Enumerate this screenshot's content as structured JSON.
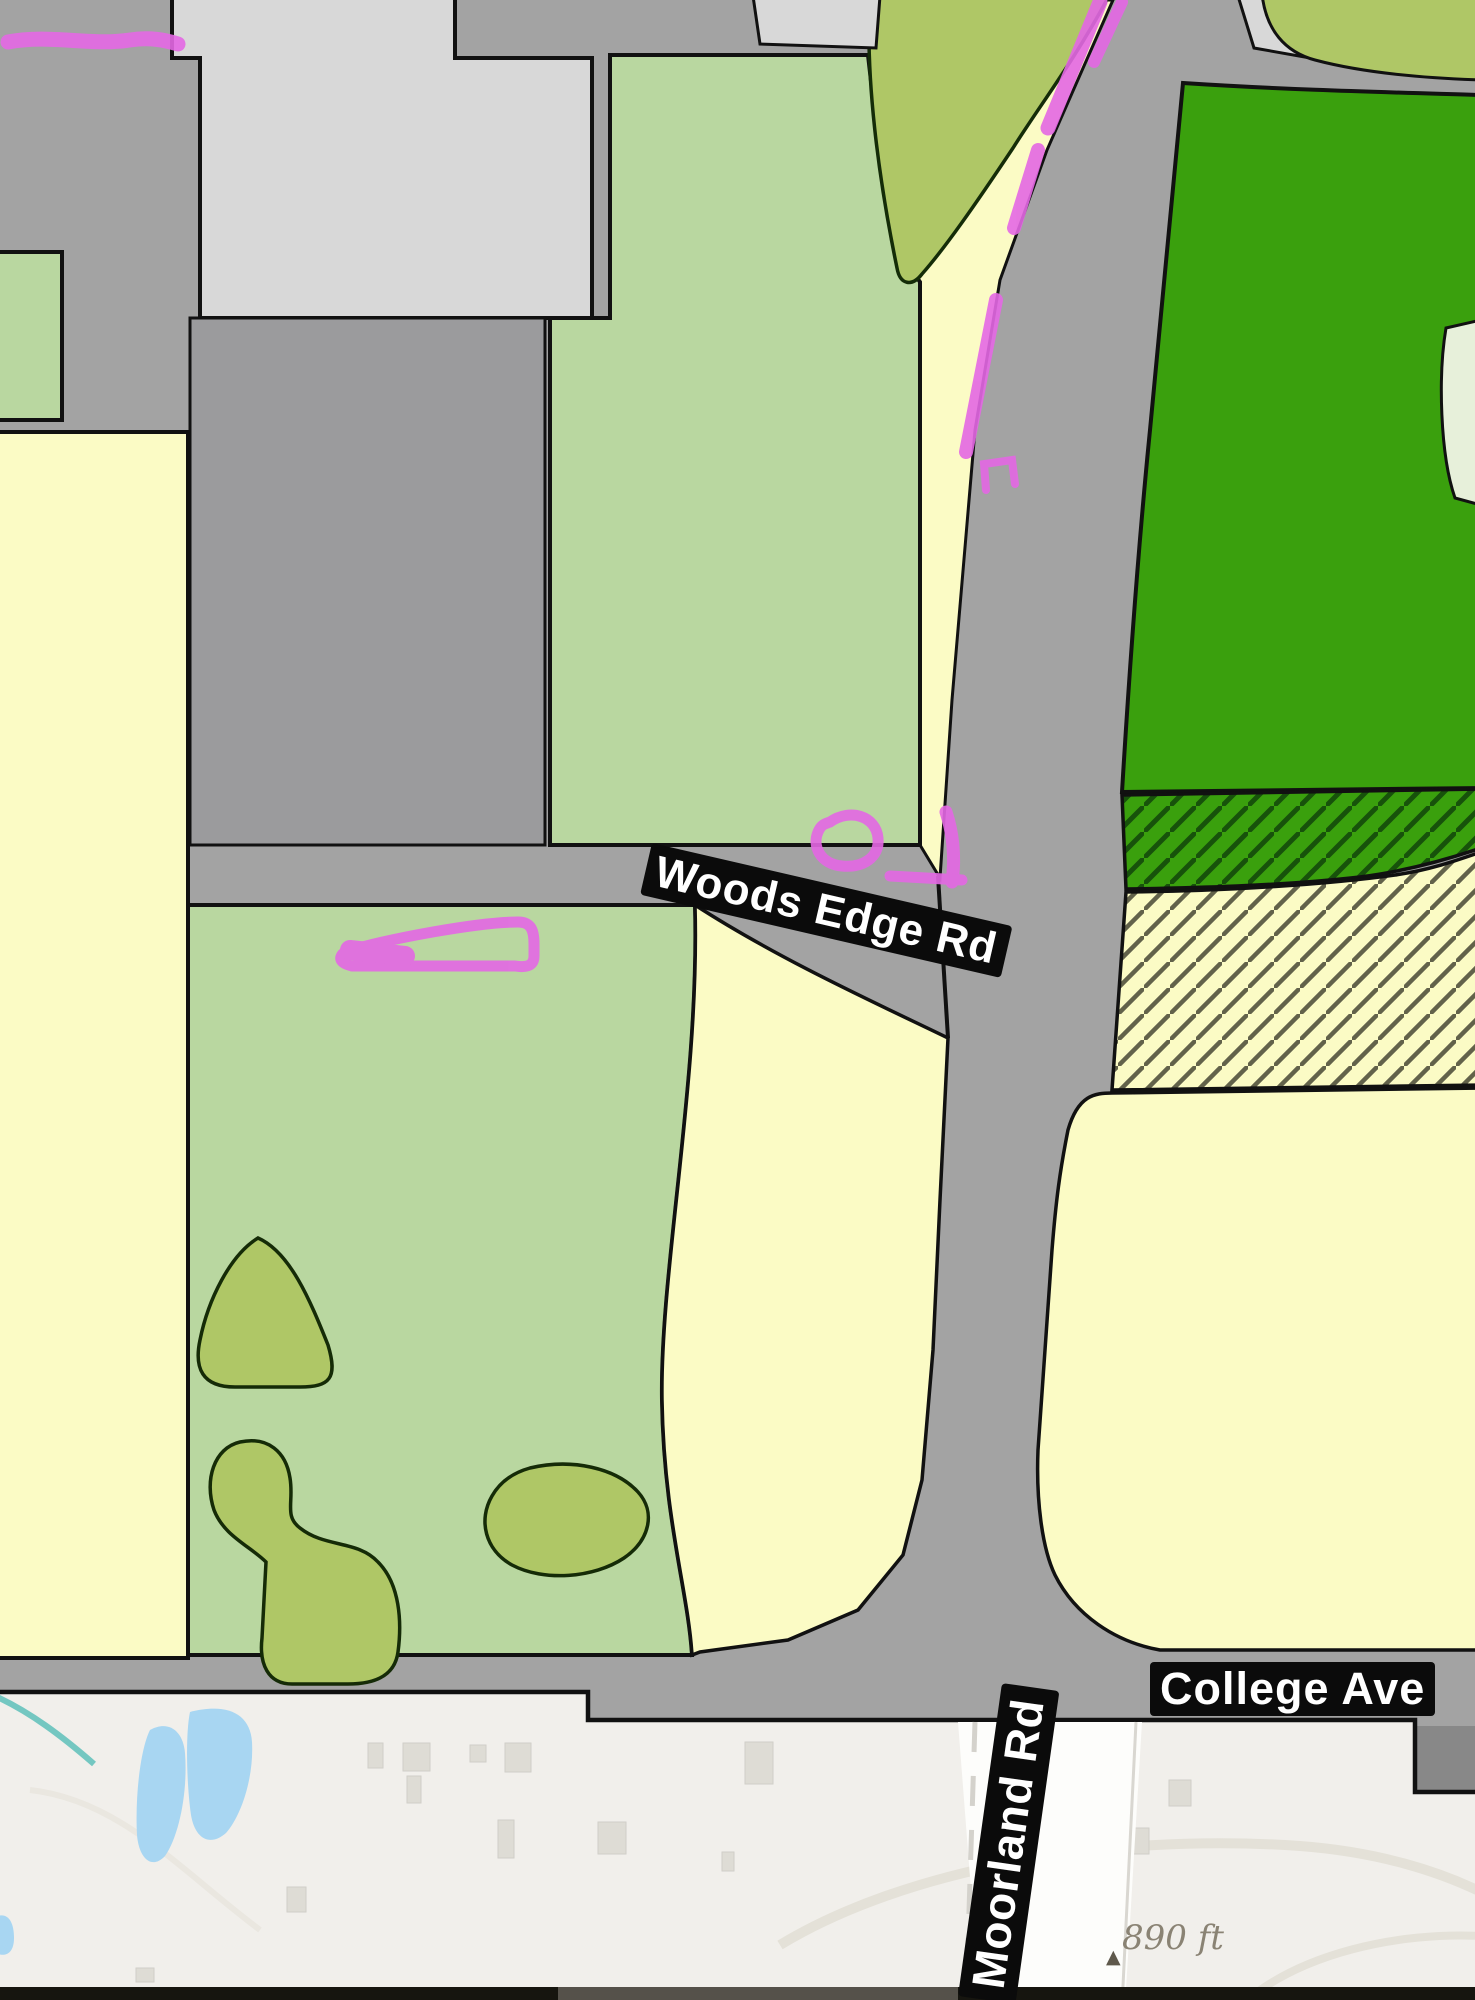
{
  "map": {
    "road_labels": {
      "woods_edge": "Woods Edge Rd",
      "college_ave": "College Ave",
      "moorland": "Moorland Rd"
    },
    "scale_indicator": {
      "text": "890 ft",
      "summit_icon": "▲"
    },
    "colors": {
      "road_gray": "#a3a3a3",
      "block_gray": "#9b9b9d",
      "parcel_light_gray": "#d8d8d8",
      "parcel_light_green": "#b9d7a0",
      "parcel_yellow": "#fbfbc5",
      "parcel_dark_green": "#3aa00d",
      "vegetation_olive": "#afc766",
      "pale_green_patch": "#e7f0da",
      "hatch_green_line": "#17520b",
      "hatch_yellow_line": "#62624a",
      "overlay_magenta": "#e468e4",
      "border_black": "#111111",
      "basemap_ground": "#f1efeb",
      "basemap_water": "#a8d6f2",
      "basemap_stream": "#74c7c1",
      "basemap_building": "#dedcd5",
      "basemap_contour": "#e4e1d8",
      "basemap_road_white": "#fdfdfb",
      "road_dash_gray": "#d4d2cc",
      "label_bg": "#0b0b0b",
      "label_text": "#ffffff",
      "scale_text_color": "#8a8374",
      "bottom_bar_dark": "#16150f",
      "bottom_bar_light": "#55514a"
    }
  }
}
